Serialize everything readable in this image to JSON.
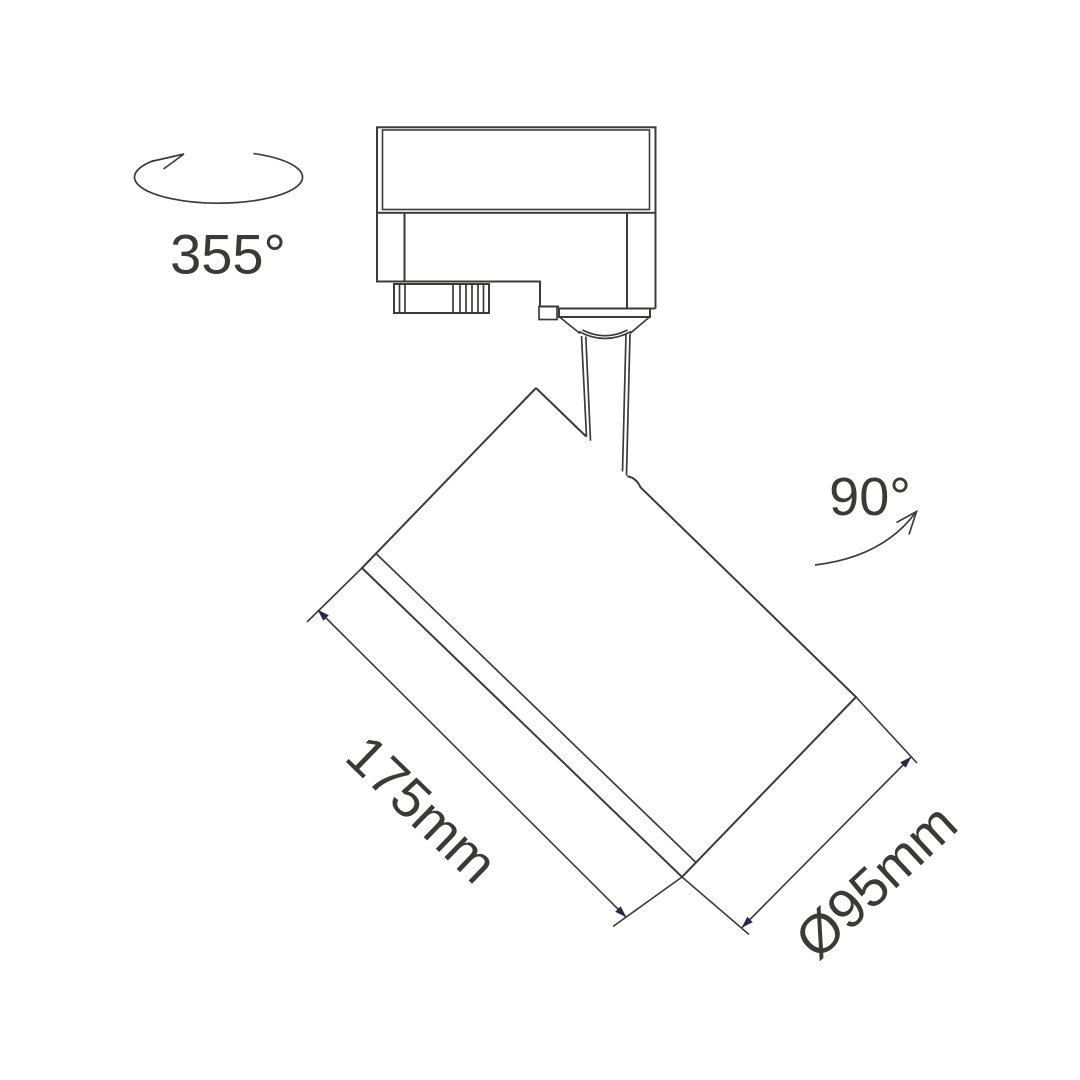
{
  "figure": {
    "kind": "technical-dimension-drawing",
    "subject": "track-mounted spotlight, side view with rotation and size annotations"
  },
  "colors": {
    "line": "#3b3b3a",
    "text": "#3a3a38",
    "arrowhead": "#26264f",
    "background": "#ffffff"
  },
  "annotations": {
    "pan_rotation": {
      "label": "355°"
    },
    "tilt_rotation": {
      "label": "90°"
    },
    "body_length": {
      "label": "175mm"
    },
    "body_diameter": {
      "label": "Ø95mm"
    }
  }
}
